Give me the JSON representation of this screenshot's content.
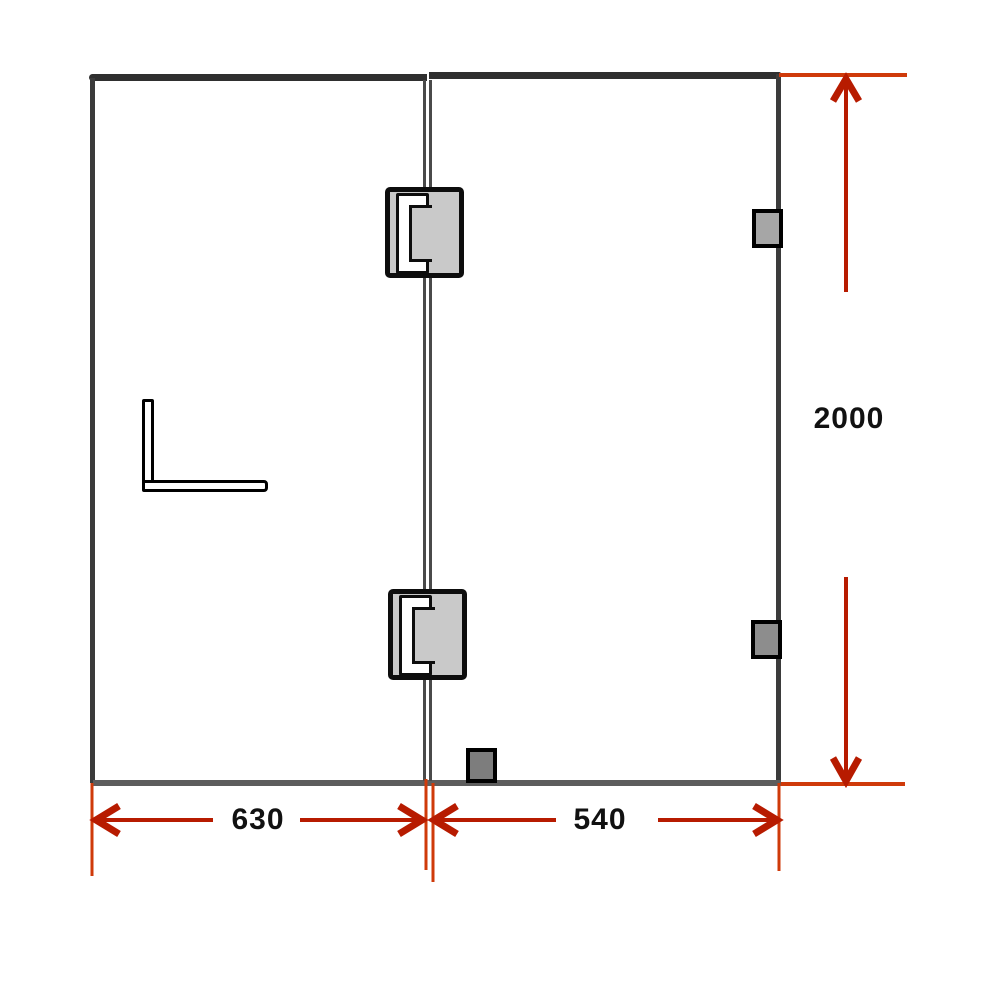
{
  "diagram": {
    "type": "technical-drawing",
    "subject": "frameless glass shower screen, two panels with hinges, wall brackets and handle",
    "dimension_labels": {
      "panel_left_width": "630",
      "panel_right_width": "540",
      "overall_height": "2000"
    },
    "colors": {
      "dimension_line": "#b71b00",
      "extension_line": "#cf3a0a",
      "frame_dark": "#2f2f2f",
      "edge_dark": "#3b3b3b",
      "bottom_edge": "#5d5d5d",
      "glass_joint": "#4a4a4a",
      "hinge_fill": "#c9c9c9",
      "hinge_outline": "#0d0d0d",
      "bracket_top_fill": "#a6a6a6",
      "bracket_bottom_fill": "#8d8d8d",
      "floor_block_fill": "#7d7d7d",
      "label_color": "#111111",
      "background": "#ffffff"
    }
  }
}
